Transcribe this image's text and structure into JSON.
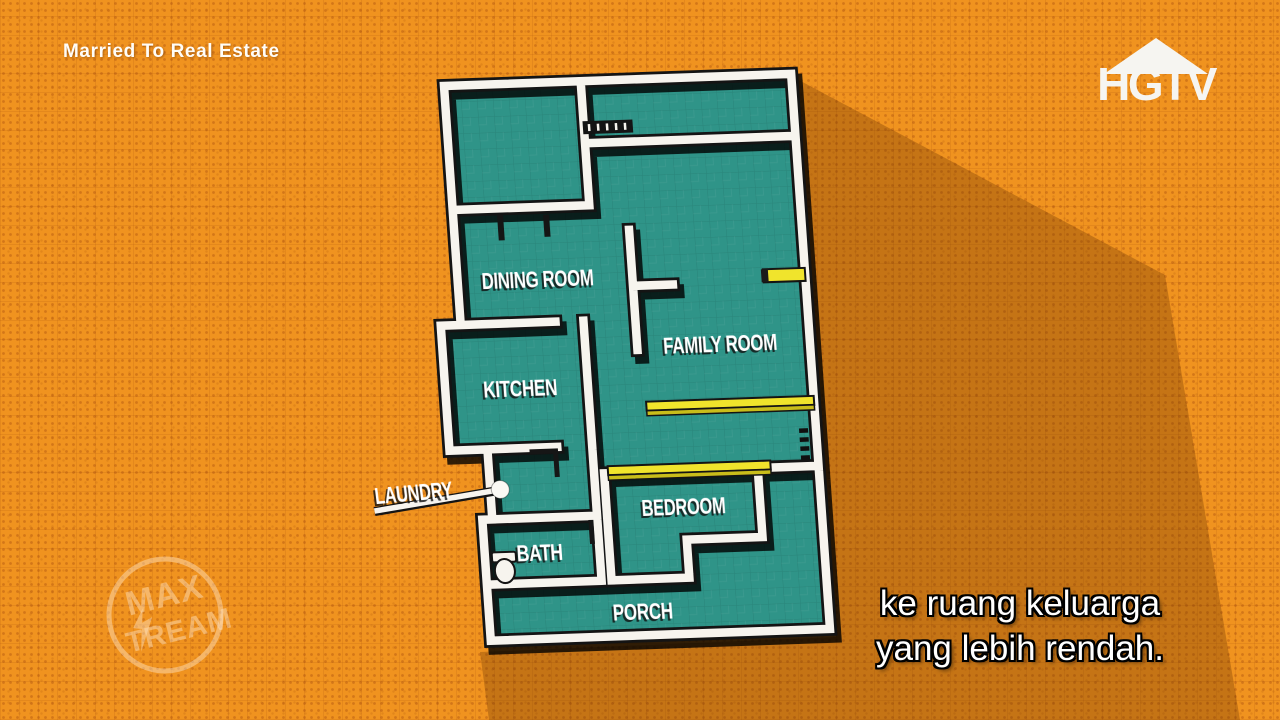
{
  "show_badge": "Married To Real Estate",
  "channel": {
    "logo_text": "HGTV"
  },
  "watermark": {
    "line1": "MAX",
    "line2": "TREAM"
  },
  "subtitles": {
    "line1": "ke ruang keluarga",
    "line2": "yang lebih rendah."
  },
  "plan": {
    "rooms": [
      {
        "label": "DINING ROOM"
      },
      {
        "label": "KITCHEN"
      },
      {
        "label": "FAMILY ROOM"
      },
      {
        "label": "BEDROOM"
      },
      {
        "label": "BATH"
      },
      {
        "label": "PORCH"
      }
    ],
    "callout": {
      "label": "LAUNDRY"
    }
  },
  "colors": {
    "background": "#f0931f",
    "shadow": "rgba(101,48,0,0.30)",
    "floor": "#2f9488",
    "wall": "#f7f4ee",
    "outline": "#141414",
    "highlight": "#f0e42c",
    "highlight-dark": "#c9bd1a",
    "text": "#ffffff",
    "watermark": "rgba(255,238,214,0.45)"
  }
}
